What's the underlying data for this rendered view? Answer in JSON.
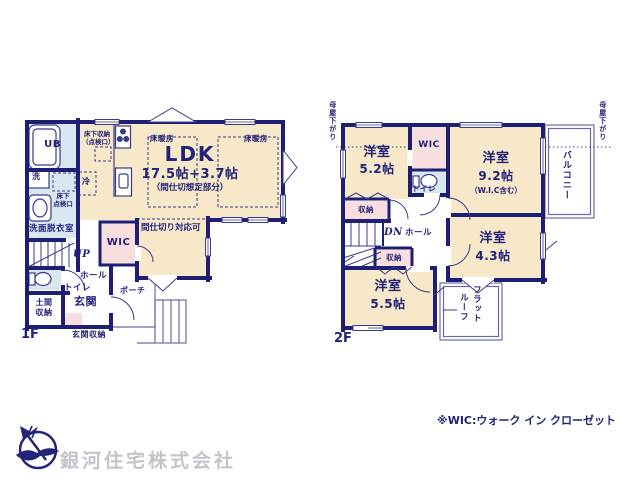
{
  "colors": {
    "wall_navy": "#1e1e74",
    "room_cream": "#f7e8c9",
    "wet_area_blue": "#d9e7f1",
    "closet_pink": "#f8dede",
    "text_navy": "#22227a",
    "company_gray": "#c4c4cc"
  },
  "common": {
    "yoshitsu": "洋室",
    "storage": "収納",
    "hall": "ホール",
    "toilet": "トイレ",
    "wic": "WIC",
    "floor_heating": "床暖房",
    "moya_sagari": "母屋下がり",
    "up": "UP",
    "dn": "DN"
  },
  "floor1": {
    "label": "1F",
    "ldk": {
      "title": "LDK",
      "size": "17.5帖+3.7帖",
      "note": "（間仕切想定部分）"
    },
    "ub": "UB",
    "wash": "洗",
    "fridge": "冷",
    "underfloor_storage": "床下収納\n（点検口）",
    "underfloor_inspection": "床下\n点検口",
    "washroom": "洗面脱衣室",
    "partition_note": "間仕切り対応可",
    "doma_storage": "土間\n収納",
    "genkan": "玄関",
    "genkan_storage": "玄関収納",
    "porch": "ポーチ"
  },
  "floor2": {
    "label": "2F",
    "room_5_2_size": "5.2帖",
    "room_9_2_size": "9.2帖",
    "room_9_2_note": "（W.I.C含む）",
    "room_4_3_size": "4.3帖",
    "room_5_5_size": "5.5帖",
    "balcony": "バルコニー",
    "flat_roof_line1": "フラット",
    "flat_roof_line2": "ルーフ"
  },
  "footer": {
    "wic_note": "※WIC:ウォーク イン クローゼット",
    "company": "銀河住宅株式会社"
  }
}
